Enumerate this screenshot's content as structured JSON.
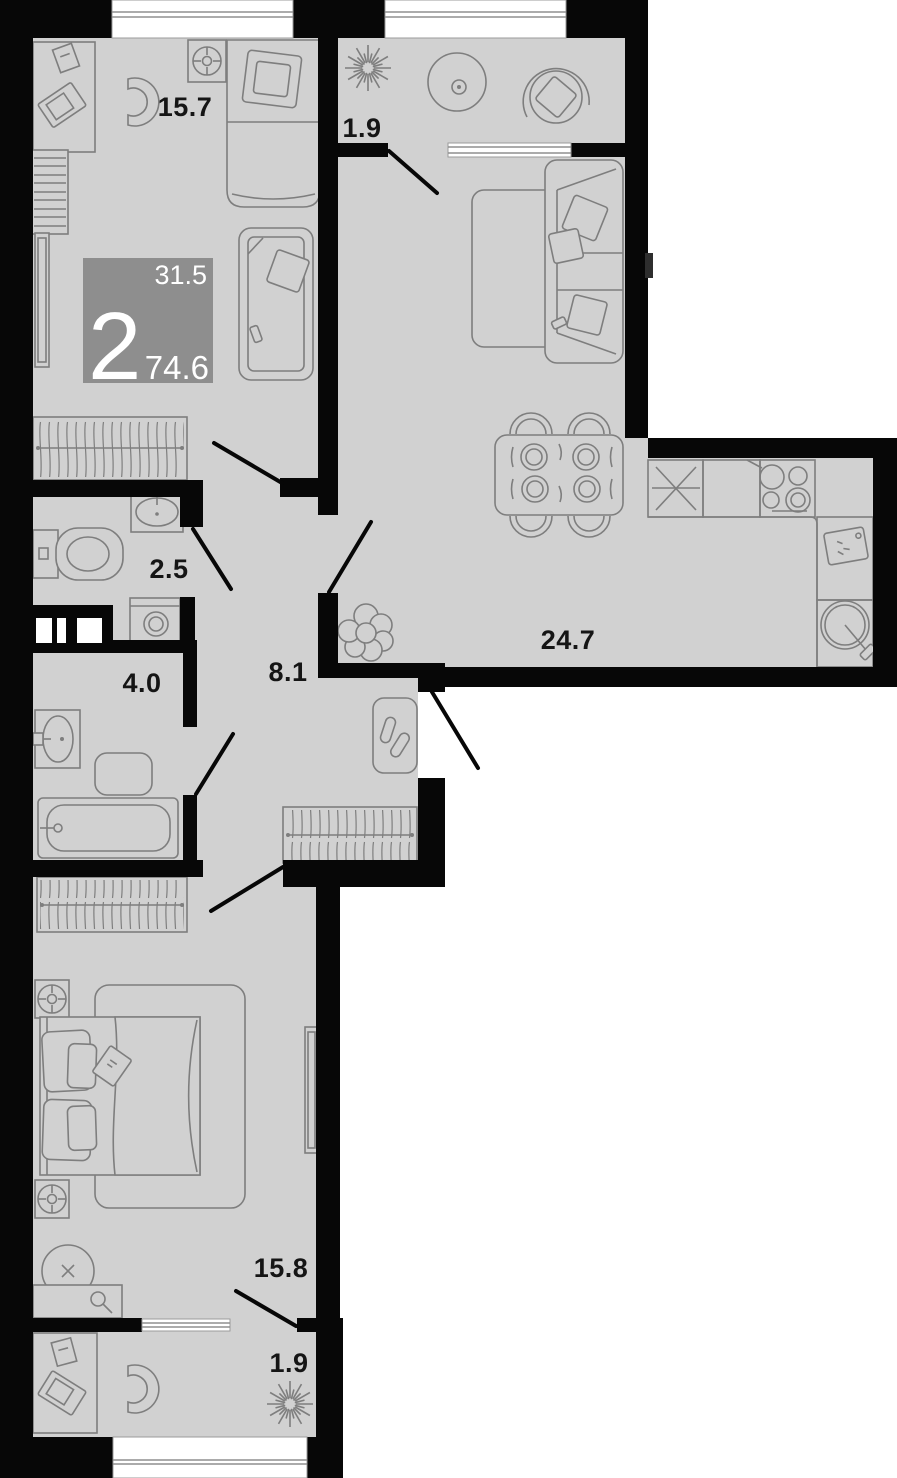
{
  "plan": {
    "type": "apartment-floor-plan",
    "badge": {
      "rooms_count": "2",
      "living_area": "31.5",
      "total_area": "74.6"
    },
    "rooms": [
      {
        "name": "bedroom-top",
        "area_label": "15.7"
      },
      {
        "name": "loggia-top",
        "area_label": "1.9"
      },
      {
        "name": "wc",
        "area_label": "2.5"
      },
      {
        "name": "bathroom",
        "area_label": "4.0"
      },
      {
        "name": "hallway",
        "area_label": "8.1"
      },
      {
        "name": "kitchen-living-room",
        "area_label": "24.7"
      },
      {
        "name": "bedroom-bottom",
        "area_label": "15.8"
      },
      {
        "name": "loggia-bottom",
        "area_label": "1.9"
      }
    ],
    "colors": {
      "wall": "#070707",
      "floor": "#d1d1d1",
      "furniture-line": "#7e7e7e",
      "badge-bg": "#8e8e8e",
      "badge-text": "#ffffff",
      "label-text": "#151515",
      "exterior": "#ffffff"
    }
  }
}
